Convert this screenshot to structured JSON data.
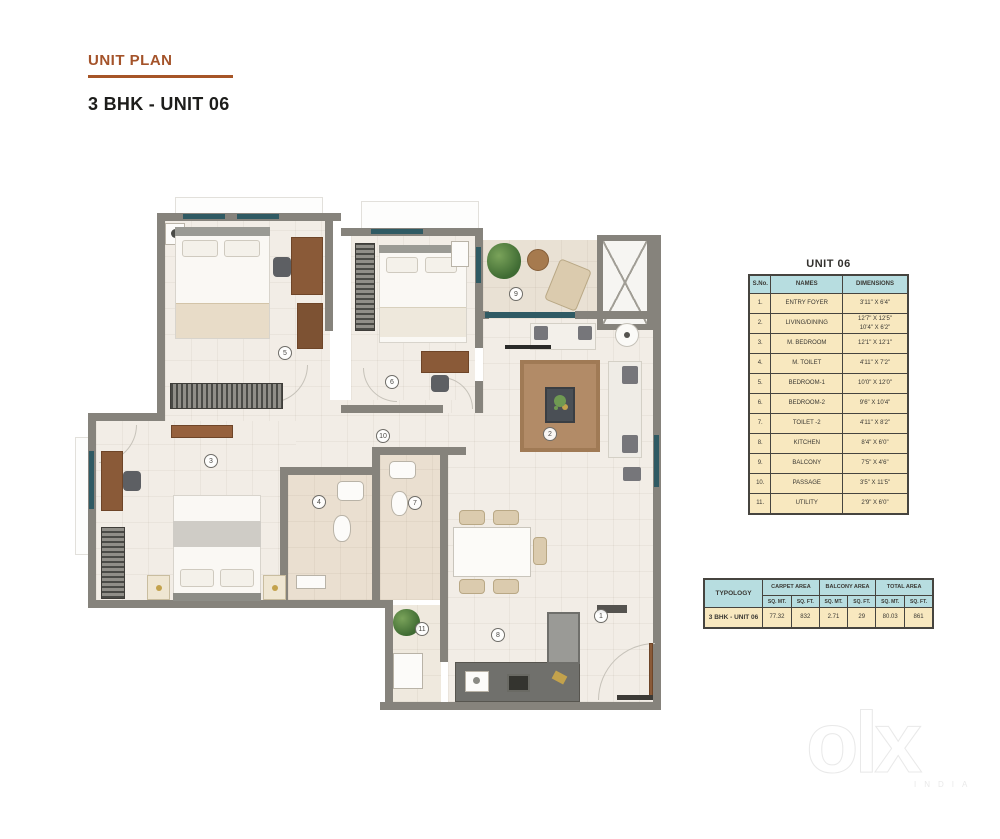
{
  "header": {
    "eyebrow": "UNIT PLAN",
    "title": "3 BHK - UNIT 06",
    "accent_color": "#a4532a"
  },
  "unit_table": {
    "title": "UNIT 06",
    "columns": [
      "S.No.",
      "NAMES",
      "DIMENSIONS"
    ],
    "header_bg": "#b7dde0",
    "body_bg": "#f8e8bf",
    "rows": [
      {
        "sno": "1.",
        "name": "ENTRY FOYER",
        "dim": "3'11\" X 6'4\"",
        "dim2": ""
      },
      {
        "sno": "2.",
        "name": "LIVING/DINING",
        "dim": "12'7\" X 12'5\"",
        "dim2": "10'4\" X 6'2\""
      },
      {
        "sno": "3.",
        "name": "M. BEDROOM",
        "dim": "12'1\" X 12'1\"",
        "dim2": ""
      },
      {
        "sno": "4.",
        "name": "M. TOILET",
        "dim": "4'11\" X 7'2\"",
        "dim2": ""
      },
      {
        "sno": "5.",
        "name": "BEDROOM-1",
        "dim": "10'0\" X 12'0\"",
        "dim2": ""
      },
      {
        "sno": "6.",
        "name": "BEDROOM-2",
        "dim": "9'6\" X 10'4\"",
        "dim2": ""
      },
      {
        "sno": "7.",
        "name": "TOILET -2",
        "dim": "4'11\" X 8'2\"",
        "dim2": ""
      },
      {
        "sno": "8.",
        "name": "KITCHEN",
        "dim": "8'4\" X 6'0\"",
        "dim2": ""
      },
      {
        "sno": "9.",
        "name": "BALCONY",
        "dim": "7'5\" X 4'6\"",
        "dim2": ""
      },
      {
        "sno": "10.",
        "name": "PASSAGE",
        "dim": "3'5\" X 11'5\"",
        "dim2": ""
      },
      {
        "sno": "11.",
        "name": "UTILITY",
        "dim": "2'9\" X 6'0\"",
        "dim2": ""
      }
    ]
  },
  "area_table": {
    "typology_label": "TYPOLOGY",
    "groups": [
      "CARPET AREA",
      "BALCONY AREA",
      "TOTAL AREA"
    ],
    "unit_headers": [
      "SQ. MT.",
      "SQ. FT.",
      "SQ. MT.",
      "SQ. FT.",
      "SQ. MT.",
      "SQ. FT."
    ],
    "row": {
      "typology": "3 BHK - UNIT 06",
      "values": [
        "77.32",
        "832",
        "2.71",
        "29",
        "80.03",
        "861"
      ]
    }
  },
  "plan": {
    "wall_color": "#86837c",
    "markers": [
      "1",
      "2",
      "3",
      "4",
      "5",
      "6",
      "7",
      "8",
      "9",
      "10",
      "11"
    ]
  },
  "watermark": {
    "logo": "olx",
    "sub": "INDIA"
  }
}
